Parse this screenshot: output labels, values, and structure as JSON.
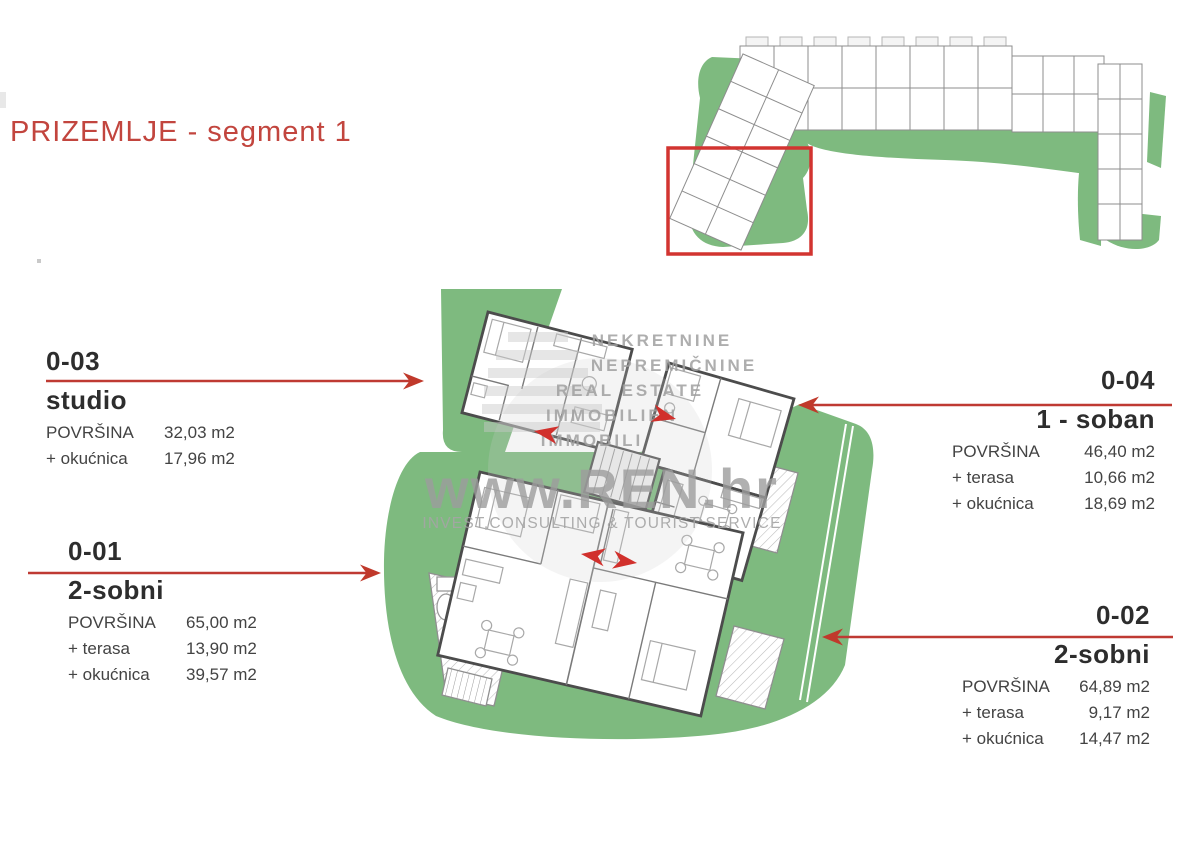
{
  "title": "PRIZEMLJE - segment 1",
  "watermark": {
    "lines": [
      "NEKRETNINE",
      "NEPREMIČNINE",
      "REAL ESTATE",
      "IMMOBILIEN",
      "IMMOBILI"
    ],
    "site": "www.REN.hr",
    "subtitle": "INVEST,CONSULTING & TOURIST SERVICE"
  },
  "units": [
    {
      "code": "0-03",
      "type": "studio",
      "rows": [
        {
          "label": "POVRŠINA",
          "value": "32,03 m2"
        },
        {
          "label": "+ okućnica",
          "value": "17,96 m2"
        }
      ]
    },
    {
      "code": "0-01",
      "type": "2-sobni",
      "rows": [
        {
          "label": "POVRŠINA",
          "value": "65,00 m2"
        },
        {
          "label": "+ terasa",
          "value": "13,90 m2"
        },
        {
          "label": "+ okućnica",
          "value": "39,57 m2"
        }
      ]
    },
    {
      "code": "0-04",
      "type": "1 - soban",
      "rows": [
        {
          "label": "POVRŠINA",
          "value": "46,40 m2"
        },
        {
          "label": "+ terasa",
          "value": "10,66 m2"
        },
        {
          "label": "+ okućnica",
          "value": "18,69 m2"
        }
      ]
    },
    {
      "code": "0-02",
      "type": "2-sobni",
      "rows": [
        {
          "label": "POVRŠINA",
          "value": "64,89 m2"
        },
        {
          "label": "+ terasa",
          "value": "9,17 m2"
        },
        {
          "label": "+ okućnica",
          "value": "14,47 m2"
        }
      ]
    }
  ],
  "colors": {
    "accent_red": "#c0392b",
    "title_red": "#c2453e",
    "landscape_green": "#7eba7f",
    "wall_gray": "#4c4c4c",
    "watermark_gray": "#9e9e9e"
  }
}
